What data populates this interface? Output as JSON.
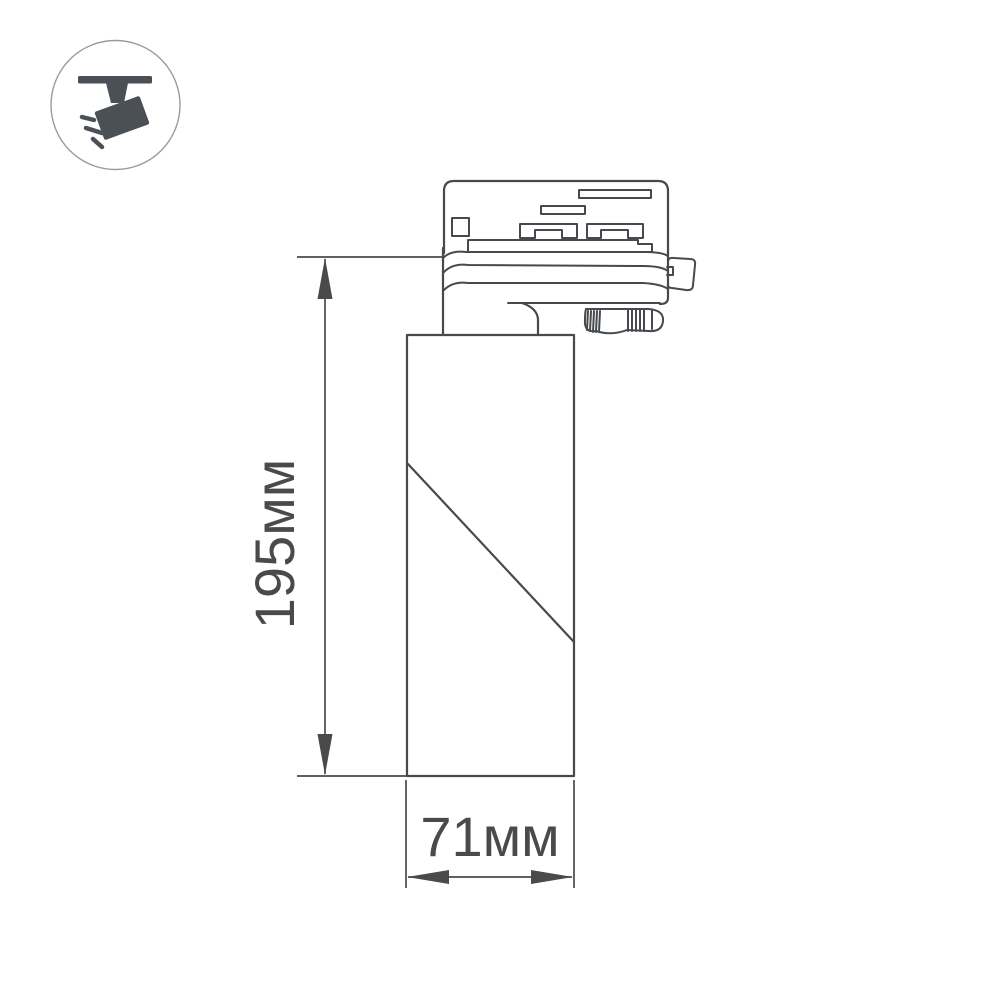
{
  "page": {
    "background_color": "#ffffff",
    "type_note": "technical dimension drawing of track-mounted spotlight luminaire"
  },
  "icon_badge": {
    "icon": "track-light-icon",
    "glyph_color": "#4b5056",
    "ring_color": "#9b9b9b"
  },
  "drawing": {
    "line_color": "#46494d",
    "dimension_color": "#4a4a4a",
    "height_label": "195мм",
    "width_label": "71мм"
  }
}
